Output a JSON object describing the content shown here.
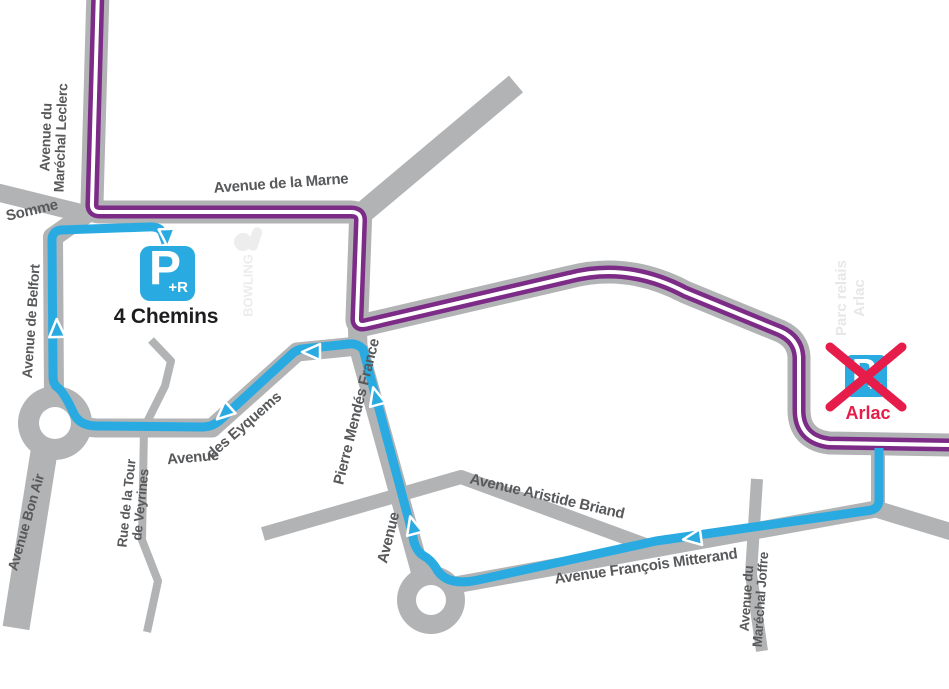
{
  "map": {
    "title_semantic": "P+R Arlac closure detour map",
    "colors": {
      "road": "#b1b3b5",
      "tram_line": "#7c2b87",
      "detour_line": "#29abe2",
      "street_label_text": "#58595b",
      "closed_red": "#e61c4a",
      "parking_name_black": "#1d1d1f",
      "watermark_gray": "#ececec"
    },
    "streets": {
      "leclerc_1": "Avenue du",
      "leclerc_2": "Maréchal Leclerc",
      "somme": "Somme",
      "marne": "Avenue de la Marne",
      "belfort": "Avenue de Belfort",
      "bon_air": "Avenue Bon Air",
      "veyrines_1": "Rue de la Tour",
      "veyrines_2": "de Veyrines",
      "eyquems_1": "Avenue",
      "eyquems_2": "des Eyquems",
      "mendes_france_1": "Avenue",
      "mendes_france_2": "Pierre Mendés France",
      "briand": "Avenue Aristide Briand",
      "mitterand": "Avenue François Mitterand",
      "joffre_1": "Avenue du",
      "joffre_2": "Maréchal Joffre"
    },
    "park_and_ride": {
      "open": {
        "name": "4 Chemins",
        "glyph": "P",
        "sub": "+R",
        "status": "open"
      },
      "closed": {
        "name": "Arlac",
        "glyph": "P",
        "sub": "+R",
        "status": "closed"
      }
    },
    "watermarks": {
      "bowling": "BOWLING",
      "parc_relais_1": "Parc relais",
      "parc_relais_2": "Arlac"
    }
  }
}
